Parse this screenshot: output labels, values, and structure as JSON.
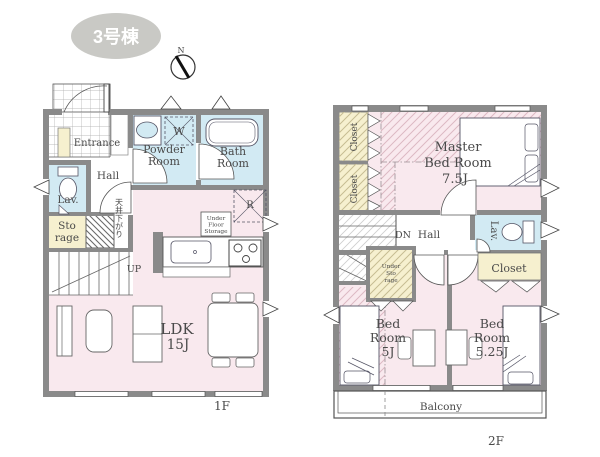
{
  "badge": {
    "label": "3号棟",
    "bg_color": "#c9c9c5",
    "text_color": "#ffffff"
  },
  "compass": {
    "north": "N"
  },
  "palette": {
    "wall": "#8a8a8a",
    "room_pink": "#f9e9ee",
    "wet_area_blue": "#d2eaf3",
    "closet_cream": "#f6f0cf",
    "label_text": "#4a4a4a"
  },
  "floor1": {
    "name": "1F",
    "labels": {
      "entrance": "Entrance",
      "hall": "Hall",
      "powder_1": "Powder",
      "powder_2": "Room",
      "bath_1": "Bath",
      "bath_2": "Room",
      "washer": "W",
      "fridge": "R",
      "lav": "Lav.",
      "storage_1": "Sto",
      "storage_2": "rage",
      "ceiling_note": "天井下がり",
      "up": "UP",
      "ldk_1": "LDK",
      "ldk_2": "15J",
      "ufs_1": "Under",
      "ufs_2": "Floor",
      "ufs_3": "Storage"
    }
  },
  "floor2": {
    "name": "2F",
    "labels": {
      "master_1": "Master",
      "master_2": "Bed Room",
      "master_3": "7.5J",
      "closet_a": "Closet",
      "closet_b": "Closet",
      "closet_c": "Closet",
      "dn": "DN",
      "hall": "Hall",
      "lav": "Lav.",
      "storage_1": "Under",
      "storage_2": "Sto",
      "storage_3": "rage",
      "bed5_1": "Bed",
      "bed5_2": "Room",
      "bed5_3": "5J",
      "bed525_1": "Bed",
      "bed525_2": "Room",
      "bed525_3": "5.25J",
      "balcony": "Balcony"
    }
  }
}
